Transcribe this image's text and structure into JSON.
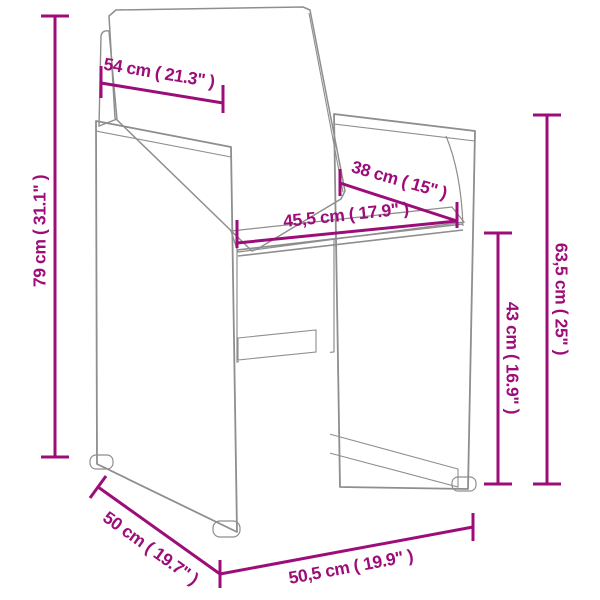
{
  "diagram": {
    "subject": "rattan-armchair-dimension-diagram",
    "accent_color": "#9c0d78",
    "outline_color": "#8e8e8e",
    "background_color": "#ffffff",
    "dimensions": [
      {
        "id": "overall-height",
        "label": "79 cm ( 31.1\" )"
      },
      {
        "id": "backrest-width",
        "label": "54 cm ( 21.3\" )"
      },
      {
        "id": "seat-width",
        "label": "45,5 cm ( 17.9\" )"
      },
      {
        "id": "seat-depth",
        "label": "38 cm ( 15\" )"
      },
      {
        "id": "backrest-height",
        "label": "63,5 cm ( 25\" )"
      },
      {
        "id": "seat-height",
        "label": "43 cm ( 16.9\" )"
      },
      {
        "id": "overall-depth",
        "label": "50 cm ( 19.7\" )"
      },
      {
        "id": "overall-width",
        "label": "50,5 cm ( 19.9\" )"
      }
    ]
  }
}
